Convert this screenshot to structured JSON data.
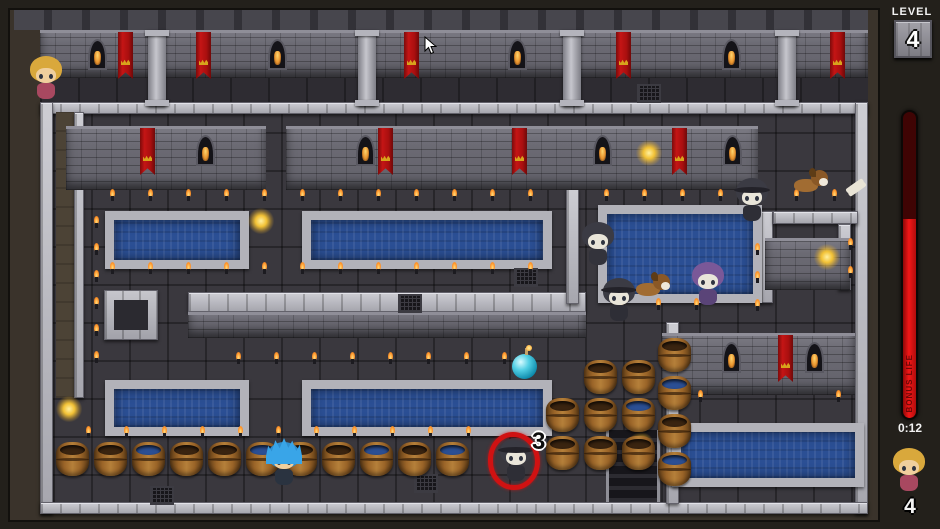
{
  "hud": {
    "level_label": "LEVEL",
    "level_value": "4",
    "bonus_label": "BONUS LIFE",
    "bonus_fill_percent": 65,
    "timer": "0:12",
    "rescues_remaining": "4",
    "marked_enemy_count": "3"
  },
  "colors": {
    "bar_red": "#f21717",
    "bar_dark_red": "#3f0404",
    "water": "#2b4f94",
    "banner_red": "#c41515",
    "stone_light": "#b2b2b9",
    "floor": "#3a383e",
    "glow_yellow": "#f2c236",
    "ring_red": "#d01212"
  },
  "map": {
    "bands": {
      "battlement": [
        14,
        10,
        854,
        20
      ],
      "brick": [
        40,
        30,
        828,
        48
      ],
      "floor_dark": [
        40,
        78,
        828,
        25
      ],
      "top_stone_row": [
        40,
        102,
        828,
        12
      ]
    },
    "top_pillars": [
      148,
      358,
      563,
      778
    ],
    "top_windows": [
      88,
      268,
      508,
      722
    ],
    "top_banners": [
      118,
      196,
      404,
      616,
      830
    ],
    "stone_walls": [
      [
        40,
        102,
        13,
        412
      ],
      [
        855,
        102,
        13,
        412
      ],
      [
        40,
        502,
        828,
        12
      ],
      [
        74,
        112,
        10,
        286
      ],
      [
        188,
        292,
        398,
        20
      ],
      [
        566,
        188,
        13,
        116
      ],
      [
        760,
        211,
        13,
        92
      ],
      [
        773,
        211,
        85,
        13
      ],
      [
        838,
        224,
        13,
        66
      ],
      [
        666,
        322,
        13,
        182
      ]
    ],
    "stone_boxes": [
      [
        104,
        290,
        54,
        50
      ]
    ],
    "dirt_paths": [
      [
        56,
        112,
        18,
        286
      ]
    ],
    "brick_walls": [
      {
        "rect": [
          66,
          126,
          200,
          64
        ],
        "windows": [
          196
        ],
        "banners": [
          140
        ]
      },
      {
        "rect": [
          286,
          126,
          472,
          64
        ],
        "windows": [
          356,
          593,
          723
        ],
        "banners": [
          378,
          512,
          672
        ]
      },
      {
        "rect": [
          662,
          333,
          193,
          62
        ],
        "windows": [
          722,
          805
        ],
        "banners": [
          778
        ]
      },
      {
        "rect": [
          188,
          312,
          398,
          26
        ],
        "windows": [],
        "banners": []
      },
      {
        "rect": [
          765,
          238,
          85,
          52
        ],
        "windows": [],
        "banners": []
      }
    ],
    "pools": [
      [
        105,
        211,
        144,
        58
      ],
      [
        302,
        211,
        250,
        58
      ],
      [
        598,
        205,
        164,
        98
      ],
      [
        105,
        380,
        144,
        56
      ],
      [
        302,
        380,
        250,
        56
      ],
      [
        672,
        423,
        192,
        64
      ]
    ],
    "grates": [
      [
        637,
        84
      ],
      [
        398,
        294
      ],
      [
        514,
        268
      ],
      [
        414,
        474
      ],
      [
        150,
        486
      ]
    ],
    "shafts": [
      [
        606,
        430,
        54,
        72
      ]
    ],
    "flames": [
      [
        110,
        189
      ],
      [
        148,
        189
      ],
      [
        186,
        189
      ],
      [
        224,
        189
      ],
      [
        262,
        189
      ],
      [
        300,
        189
      ],
      [
        338,
        189
      ],
      [
        376,
        189
      ],
      [
        414,
        189
      ],
      [
        452,
        189
      ],
      [
        490,
        189
      ],
      [
        528,
        189
      ],
      [
        604,
        189
      ],
      [
        642,
        189
      ],
      [
        680,
        189
      ],
      [
        718,
        189
      ],
      [
        756,
        189
      ],
      [
        794,
        189
      ],
      [
        832,
        189
      ],
      [
        94,
        216
      ],
      [
        94,
        243
      ],
      [
        94,
        270
      ],
      [
        94,
        297
      ],
      [
        94,
        324
      ],
      [
        94,
        351
      ],
      [
        110,
        262
      ],
      [
        148,
        262
      ],
      [
        186,
        262
      ],
      [
        224,
        262
      ],
      [
        262,
        262
      ],
      [
        300,
        262
      ],
      [
        338,
        262
      ],
      [
        376,
        262
      ],
      [
        414,
        262
      ],
      [
        452,
        262
      ],
      [
        490,
        262
      ],
      [
        528,
        262
      ],
      [
        755,
        243
      ],
      [
        755,
        271
      ],
      [
        755,
        299
      ],
      [
        848,
        238
      ],
      [
        848,
        266
      ],
      [
        618,
        298
      ],
      [
        656,
        298
      ],
      [
        694,
        298
      ],
      [
        236,
        352
      ],
      [
        274,
        352
      ],
      [
        312,
        352
      ],
      [
        350,
        352
      ],
      [
        388,
        352
      ],
      [
        426,
        352
      ],
      [
        464,
        352
      ],
      [
        502,
        352
      ],
      [
        86,
        426
      ],
      [
        124,
        426
      ],
      [
        162,
        426
      ],
      [
        200,
        426
      ],
      [
        238,
        426
      ],
      [
        276,
        426
      ],
      [
        314,
        426
      ],
      [
        352,
        426
      ],
      [
        390,
        426
      ],
      [
        428,
        426
      ],
      [
        466,
        426
      ],
      [
        698,
        390
      ],
      [
        836,
        390
      ]
    ],
    "glows": [
      [
        248,
        208
      ],
      [
        636,
        140
      ],
      [
        814,
        244
      ],
      [
        628,
        432
      ],
      [
        56,
        396
      ]
    ],
    "barrel_row": {
      "y": 442,
      "x": [
        56,
        94,
        132,
        170,
        208,
        246,
        284,
        322,
        360,
        398,
        436
      ],
      "water_tops": [
        2,
        5,
        8,
        10
      ]
    },
    "barrels_stacked": [
      {
        "x": 584,
        "y": 360
      },
      {
        "x": 622,
        "y": 360
      },
      {
        "x": 546,
        "y": 398
      },
      {
        "x": 584,
        "y": 398
      },
      {
        "x": 622,
        "y": 398,
        "water": true
      },
      {
        "x": 546,
        "y": 436
      },
      {
        "x": 584,
        "y": 436
      },
      {
        "x": 622,
        "y": 436
      },
      {
        "x": 658,
        "y": 338
      },
      {
        "x": 658,
        "y": 376,
        "water": true
      },
      {
        "x": 658,
        "y": 414
      },
      {
        "x": 658,
        "y": 452,
        "water": true
      }
    ]
  },
  "sprites": [
    {
      "type": "girl",
      "name": "captive-girl-npc",
      "x": 28,
      "y": 56
    },
    {
      "type": "player",
      "name": "player-character",
      "x": 266,
      "y": 442
    },
    {
      "type": "hood",
      "name": "enemy-hooded",
      "x": 580,
      "y": 222
    },
    {
      "type": "hoodhat",
      "name": "enemy-hooded-hat",
      "x": 734,
      "y": 178
    },
    {
      "type": "hoodhat",
      "name": "enemy-hooded-hat",
      "x": 601,
      "y": 278
    },
    {
      "type": "purple",
      "name": "enemy-purple-hood",
      "x": 690,
      "y": 262
    },
    {
      "type": "hoodhat",
      "name": "enemy-marked",
      "x": 498,
      "y": 438,
      "marked": true
    },
    {
      "type": "dog",
      "name": "dog",
      "x": 636,
      "y": 274
    },
    {
      "type": "dog",
      "name": "dog",
      "x": 794,
      "y": 170
    },
    {
      "type": "bone",
      "name": "bone-pickup",
      "x": 847,
      "y": 184
    },
    {
      "type": "bomb",
      "name": "water-bomb",
      "x": 512,
      "y": 354
    }
  ],
  "cursor": {
    "x": 424,
    "y": 36
  }
}
